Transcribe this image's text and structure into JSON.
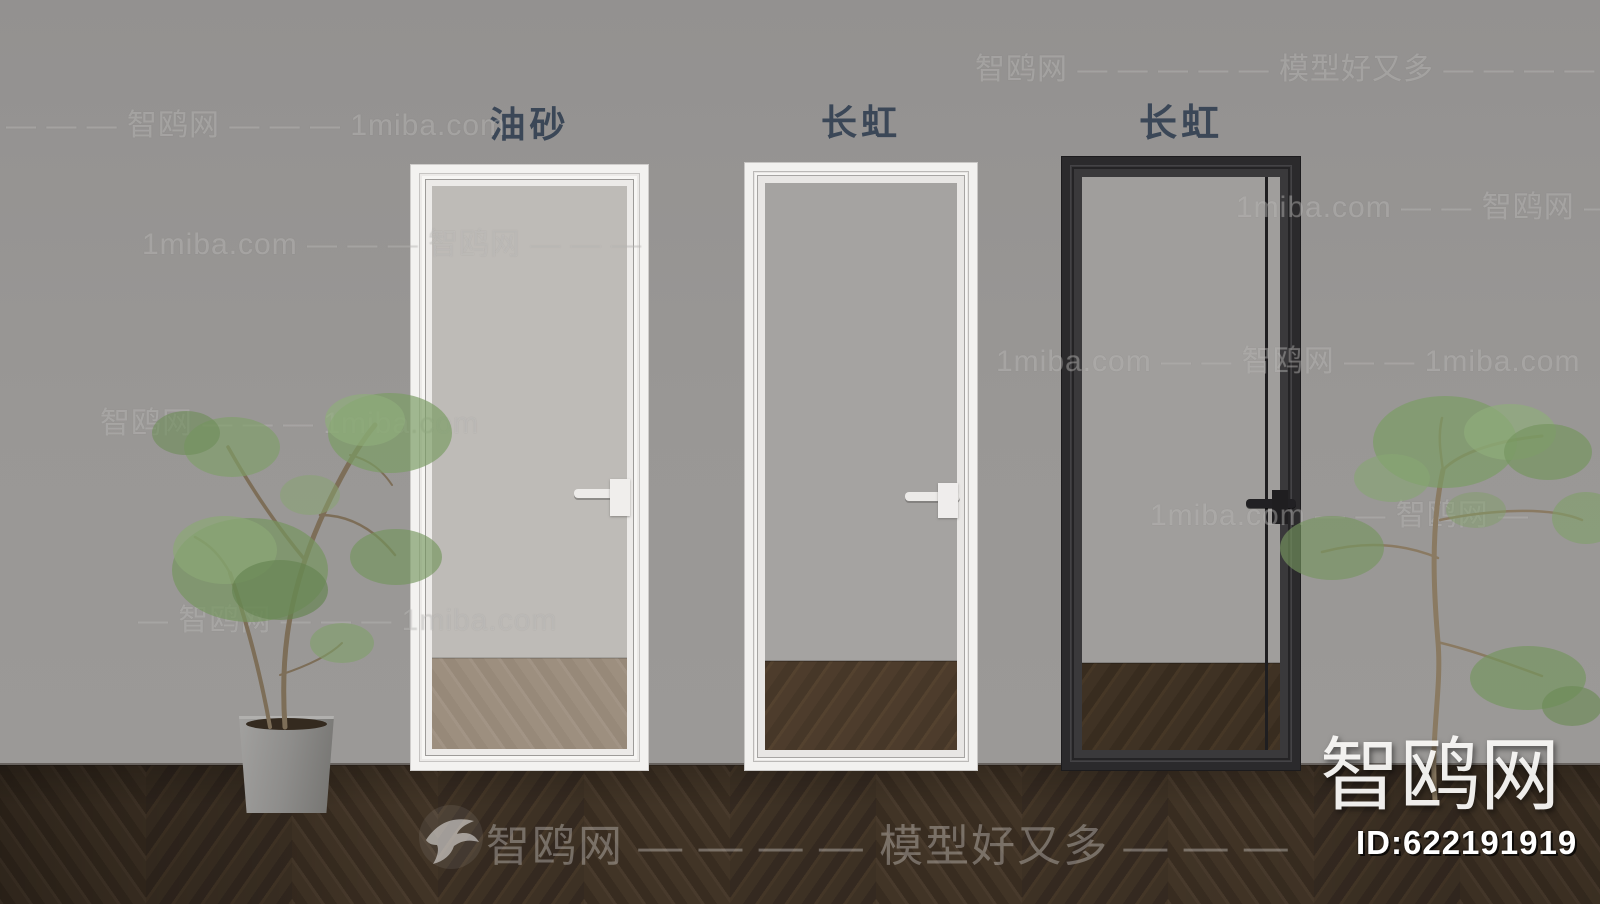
{
  "doors": [
    {
      "label": "油砂",
      "frame": "white",
      "glass": "frosted"
    },
    {
      "label": "长虹",
      "frame": "white",
      "glass": "clear"
    },
    {
      "label": "长虹",
      "frame": "black",
      "glass": "tinted"
    }
  ],
  "watermarks": {
    "items": [
      {
        "text": "智鸥网 — — — — — 模型好又多 — — — —"
      },
      {
        "text": "— — — 智鸥网 — — — 1miba.com"
      },
      {
        "text": "1miba.com — — 智鸥网 — —"
      },
      {
        "text": "1miba.com — — — 智鸥网 — — —"
      },
      {
        "text": "1miba.com — — 智鸥网 — — 1miba.com"
      },
      {
        "text": "智鸥网 — — — 1miba.com"
      },
      {
        "text": "1miba.com — — 智鸥网 —"
      },
      {
        "text": "— 智鸥网 — — — 1miba.com"
      }
    ],
    "banner": {
      "text": "智鸥网 — — — — 模型好又多 — — —"
    }
  },
  "branding": {
    "site": "智鸥网",
    "id": "ID:622191919"
  },
  "colors": {
    "wall": "#999795",
    "floor": "#3a2e23",
    "label": "#3b4757",
    "frame_white": "#f3f2f0",
    "frame_black": "#2b2a2c"
  }
}
